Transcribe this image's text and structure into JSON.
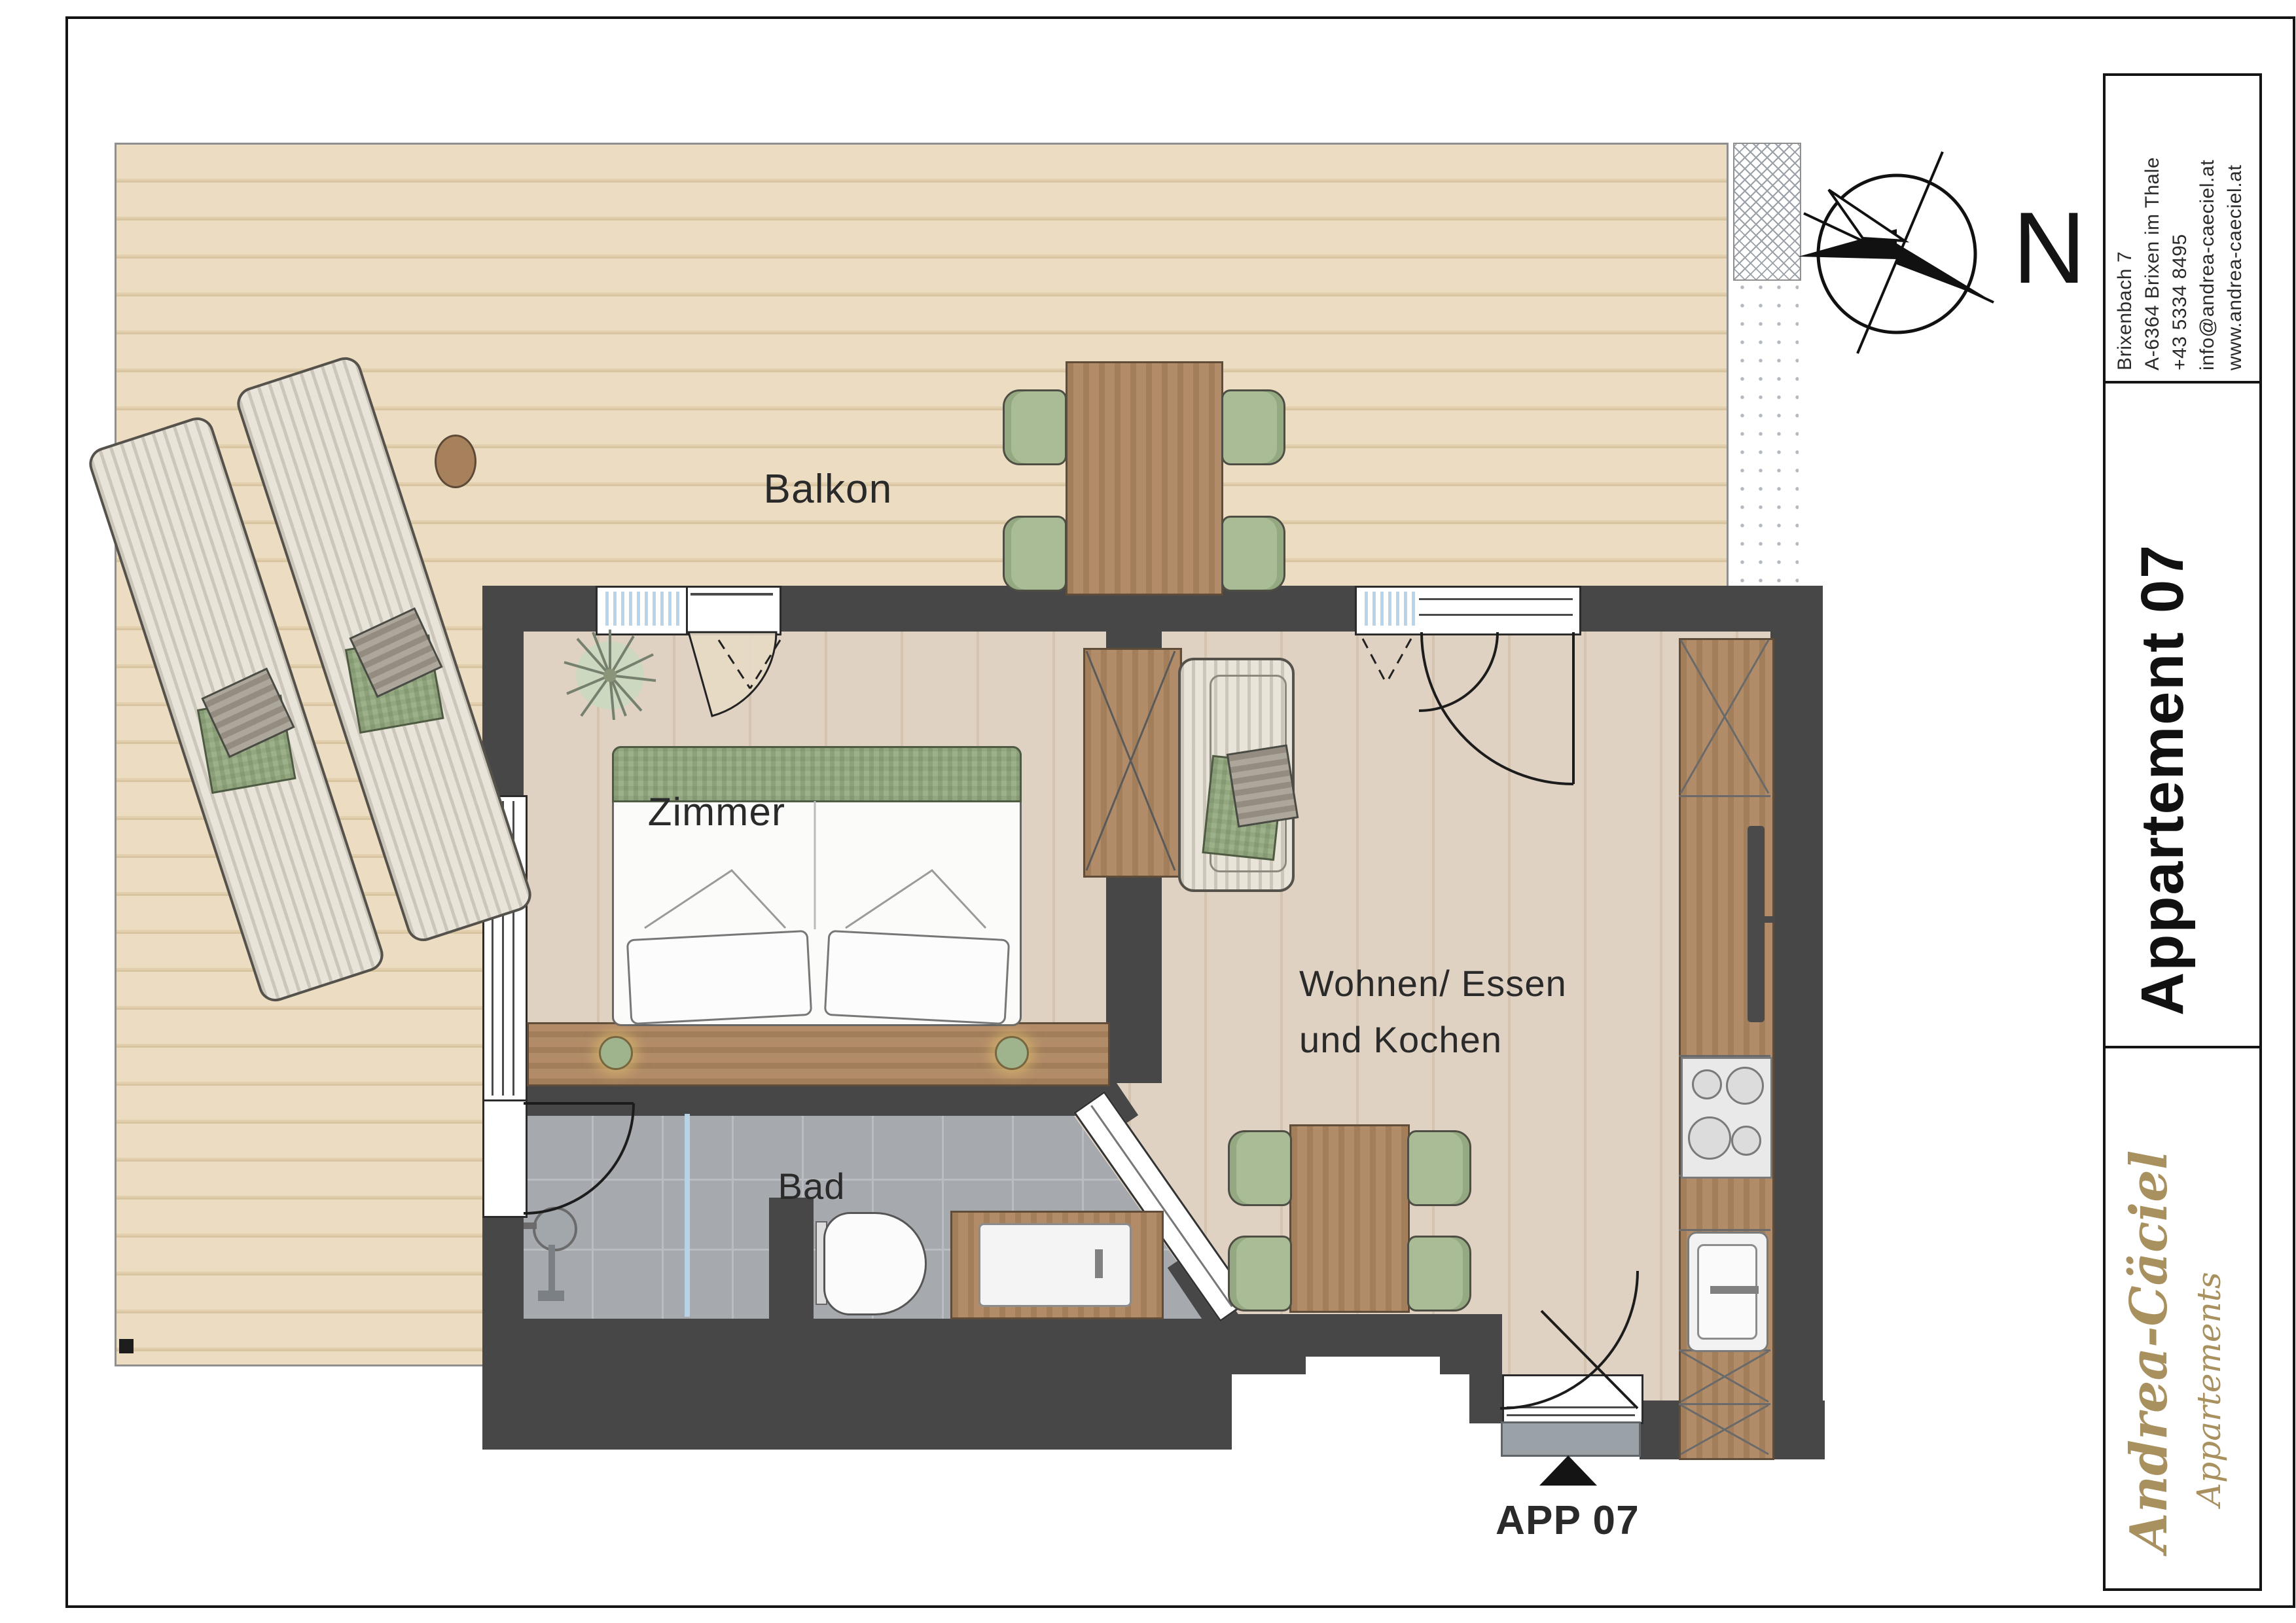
{
  "rooms": {
    "balcony": "Balkon",
    "bedroom": "Zimmer",
    "bathroom": "Bad",
    "living_line1": "Wohnen/ Essen",
    "living_line2": "und Kochen"
  },
  "entrance": {
    "label": "APP 07"
  },
  "compass": {
    "label": "N"
  },
  "title_block": {
    "address_lines": [
      "Brixenbach 7",
      "A-6364 Brixen im Thale",
      "+43 5334 8495",
      "info@andrea-caeciel.at",
      "www.andrea-caeciel.at"
    ],
    "apartment": "Appartement 07",
    "brand_name": "Andrea-Cäciel",
    "brand_subtitle": "Appartements"
  },
  "colors": {
    "wall": "#474747",
    "deck_wood": "#ecdcc2",
    "interior_wood": "#dfd1c1",
    "furniture_wood": "#b28c68",
    "bath_tile": "#a6aaae",
    "textile_green": "#a9bc96",
    "window_blue": "#b9d4e8",
    "brand_gold": "#a8915f"
  }
}
